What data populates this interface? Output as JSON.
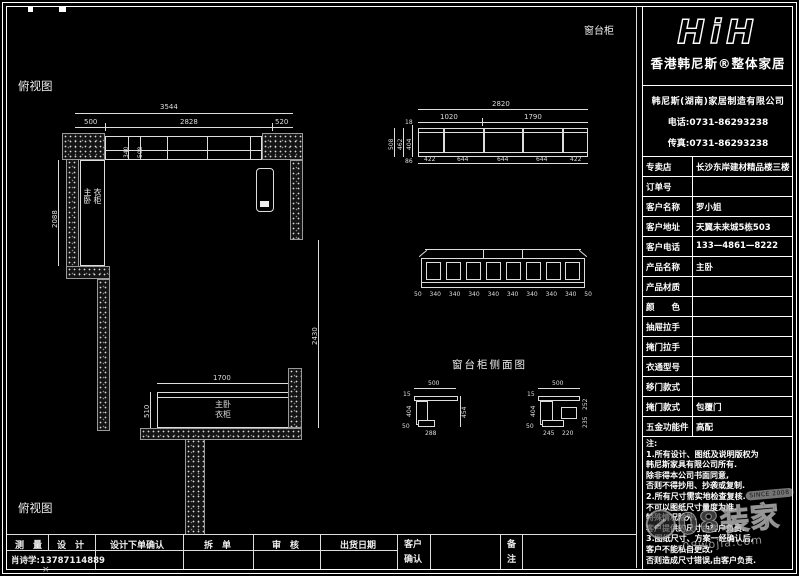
{
  "drawing": {
    "labels": {
      "plan_top": "俯视图",
      "plan_bottom": "俯视图",
      "window_cabinet": "窗台柜",
      "side_view_title": "窗台柜侧面图"
    },
    "plan": {
      "dim_overall": "3544",
      "dim_left": "500",
      "dim_mid": "2828",
      "dim_right": "520",
      "dim_band_a": "340",
      "dim_band_b": "508",
      "dim_wardrobe_h": "2088",
      "dim_right_side": "2430",
      "dim_bottom_w": "1700",
      "dim_bottom_d": "510",
      "wardrobe_label_a": "主卧",
      "wardrobe_label_b": "衣柜",
      "bottom_label_a": "主卧",
      "bottom_label_b": "衣柜"
    },
    "elevation": {
      "dim_overall": "2820",
      "dim_seg1": "1020",
      "dim_seg2": "1790",
      "bottom": [
        "422",
        "644",
        "644",
        "644",
        "422"
      ],
      "left": [
        "508",
        "462",
        "404"
      ],
      "small_top": "18",
      "small_bottom": "86"
    },
    "front": {
      "bottom": [
        "50",
        "340",
        "340",
        "340",
        "340",
        "340",
        "340",
        "340",
        "340",
        "50"
      ]
    },
    "side_left": {
      "top": "500",
      "corner": "15",
      "left": "404",
      "left_small": "50",
      "bottom": "288",
      "right": "454"
    },
    "side_right": {
      "top": "500",
      "corner": "15",
      "left": "404",
      "left_small": "50",
      "bottom_a": "245",
      "bottom_b": "220",
      "right_a": "252",
      "right_b": "235"
    }
  },
  "titleblock": {
    "logo": "HiH",
    "brand": "香港韩尼斯®整体家居",
    "company": "韩尼斯(湖南)家居制造有限公司",
    "phone": "电话:0731-86293238",
    "fax": "传真:0731-86293238",
    "rows": [
      {
        "label": "专卖店",
        "value": "长沙东岸建材精品楼三楼"
      },
      {
        "label": "订单号",
        "value": ""
      },
      {
        "label": "客户名称",
        "value": "罗小姐"
      },
      {
        "label": "客户地址",
        "value": "天翼未来城5栋503"
      },
      {
        "label": "客户电话",
        "value": "133—4861—8222"
      },
      {
        "label": "产品名称",
        "value": "主卧"
      },
      {
        "label": "产品材质",
        "value": ""
      },
      {
        "label": "颜　　色",
        "value": ""
      },
      {
        "label": "抽屉拉手",
        "value": ""
      },
      {
        "label": "掩门拉手",
        "value": ""
      },
      {
        "label": "衣通型号",
        "value": ""
      },
      {
        "label": "移门款式",
        "value": ""
      },
      {
        "label": "掩门款式",
        "value": "包覆门"
      },
      {
        "label": "五金功能件",
        "value": "高配"
      }
    ],
    "notes": [
      "注:",
      "1.所有设计、图纸及说明版权为",
      "韩尼斯家具有限公司所有.",
      "除非得本公司书面同意,",
      "否则不得抄用、抄袭或复制.",
      "2.所有尺寸需实地检查复核.",
      "不可以图纸尺寸量度为准.",
      "特殊情况除外.",
      "客户提供的尺寸由客户负责.",
      "3.图纸尺寸、方案一经确认后,",
      "客户不能私自更改,",
      "否则造成尺寸错误,由客户负责."
    ]
  },
  "bottom_bar": {
    "headers": [
      "测　量",
      "设　计",
      "设计下单确认",
      "拆　单",
      "审　核",
      "出货日期"
    ],
    "measure_value": "肖诗学:13787114889",
    "confirm_line1": "客户",
    "confirm_line2": "确认",
    "remark_line1": "备",
    "remark_line2": "注"
  },
  "watermark": {
    "brand": "08装家",
    "url": "08wojia.com",
    "badge": "SINCE 2008"
  }
}
